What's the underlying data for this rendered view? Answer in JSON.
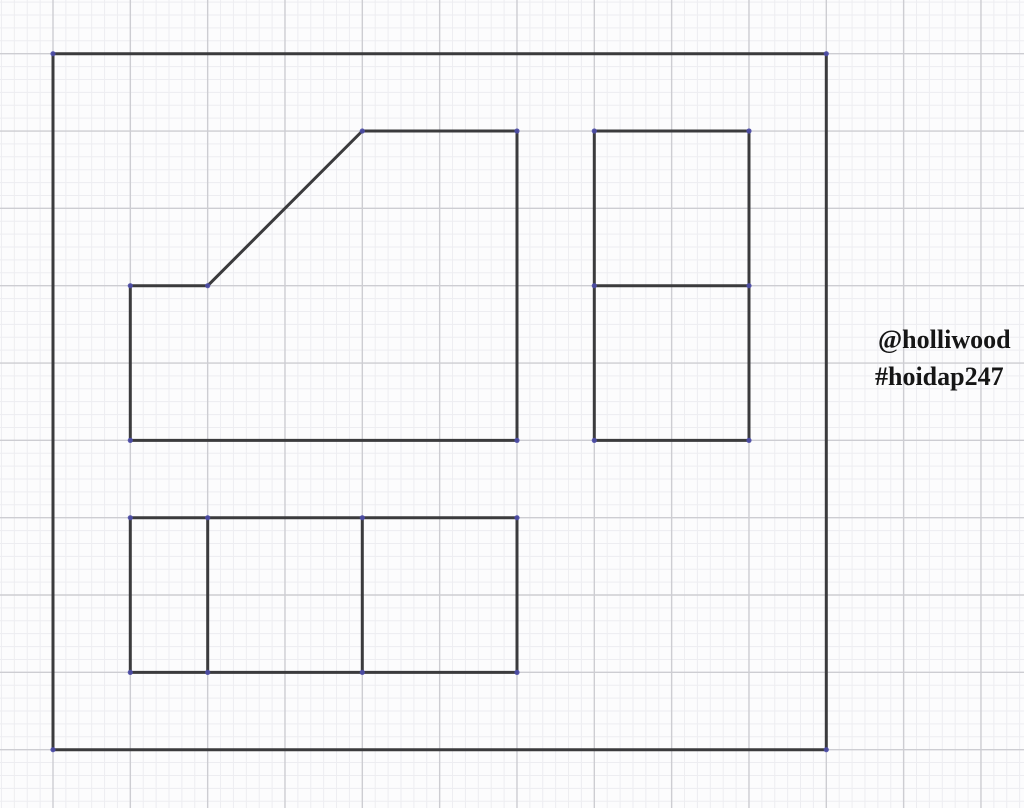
{
  "canvas": {
    "width": 1024,
    "height": 808,
    "background": "#fcfcfd"
  },
  "grid": {
    "origin_x": 53,
    "origin_y": 53.7,
    "major_spacing": 77.33,
    "minor_per_major": 6,
    "minor_color": "#ededf1",
    "major_color": "#cdcdd2",
    "minor_width": 1,
    "major_width": 1.4
  },
  "drawing": {
    "stroke_color": "#3b3b3d",
    "stroke_width": 3,
    "vertex_color": "#4d4da8",
    "vertex_radius": 2.6,
    "shapes": [
      {
        "name": "outer-border",
        "type": "polygon",
        "points": [
          [
            53,
            53.7
          ],
          [
            826.3,
            53.7
          ],
          [
            826.3,
            749.7
          ],
          [
            53,
            749.7
          ]
        ]
      },
      {
        "name": "front-view-outline",
        "type": "polygon",
        "points": [
          [
            130.3,
            440.4
          ],
          [
            130.3,
            285.7
          ],
          [
            207.7,
            285.7
          ],
          [
            362.3,
            131
          ],
          [
            517,
            131
          ],
          [
            517,
            440.4
          ]
        ]
      },
      {
        "name": "side-view-outline",
        "type": "polygon",
        "points": [
          [
            594.3,
            131
          ],
          [
            749,
            131
          ],
          [
            749,
            440.4
          ],
          [
            594.3,
            440.4
          ]
        ]
      },
      {
        "name": "side-view-divider",
        "type": "line",
        "points": [
          [
            594.3,
            285.7
          ],
          [
            749,
            285.7
          ]
        ]
      },
      {
        "name": "top-view-outline",
        "type": "polygon",
        "points": [
          [
            130.3,
            517.7
          ],
          [
            517,
            517.7
          ],
          [
            517,
            672.4
          ],
          [
            130.3,
            672.4
          ]
        ]
      },
      {
        "name": "top-view-divider-left",
        "type": "line",
        "points": [
          [
            207.7,
            517.7
          ],
          [
            207.7,
            672.4
          ]
        ]
      },
      {
        "name": "top-view-divider-right",
        "type": "line",
        "points": [
          [
            362.3,
            517.7
          ],
          [
            362.3,
            672.4
          ]
        ]
      }
    ],
    "vertices": [
      [
        53,
        53.7
      ],
      [
        826.3,
        53.7
      ],
      [
        826.3,
        749.7
      ],
      [
        53,
        749.7
      ],
      [
        130.3,
        440.4
      ],
      [
        130.3,
        285.7
      ],
      [
        207.7,
        285.7
      ],
      [
        362.3,
        131
      ],
      [
        517,
        131
      ],
      [
        517,
        440.4
      ],
      [
        594.3,
        131
      ],
      [
        749,
        131
      ],
      [
        749,
        440.4
      ],
      [
        594.3,
        440.4
      ],
      [
        594.3,
        285.7
      ],
      [
        749,
        285.7
      ],
      [
        130.3,
        517.7
      ],
      [
        517,
        517.7
      ],
      [
        517,
        672.4
      ],
      [
        130.3,
        672.4
      ],
      [
        207.7,
        517.7
      ],
      [
        207.7,
        672.4
      ],
      [
        362.3,
        517.7
      ],
      [
        362.3,
        672.4
      ]
    ]
  },
  "watermark": {
    "line1": "@holliwood",
    "line2": "#hoidap247",
    "color": "#161616"
  }
}
